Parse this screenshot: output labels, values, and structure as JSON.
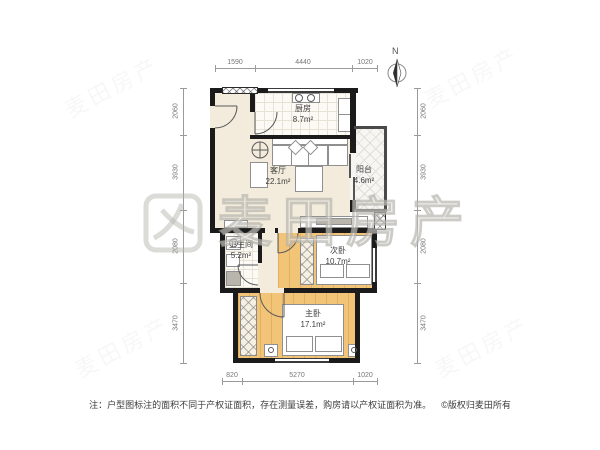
{
  "watermark": {
    "brand": "麦田房产"
  },
  "compass": {
    "north": "N"
  },
  "rooms": {
    "kitchen": {
      "name": "厨房",
      "area": "8.7m²"
    },
    "living": {
      "name": "客厅",
      "area": "22.1m²"
    },
    "balcony": {
      "name": "阳台",
      "area": "4.6m²"
    },
    "bathroom": {
      "name": "卫生间",
      "area": "5.2m²"
    },
    "bedroom2": {
      "name": "次卧",
      "area": "10.7m²"
    },
    "master": {
      "name": "主卧",
      "area": "17.1m²"
    }
  },
  "dims": {
    "top": [
      "1590",
      "4440",
      "1020"
    ],
    "bottom": [
      "820",
      "5270",
      "1020"
    ],
    "left": [
      "2060",
      "3930",
      "2080",
      "3470"
    ],
    "right": [
      "2060",
      "3930",
      "2080",
      "3470"
    ]
  },
  "footer": {
    "note": "注：户型图标注的面积不同于产权证面积，存在测量误差，购房请以产权证面积为准。",
    "copyright": "©版权归麦田所有"
  },
  "colors": {
    "wall": "#1b1b1b",
    "floor_cream": "#f3ecdc",
    "floor_wood": "#f1c478",
    "dimension_text": "#777777"
  }
}
